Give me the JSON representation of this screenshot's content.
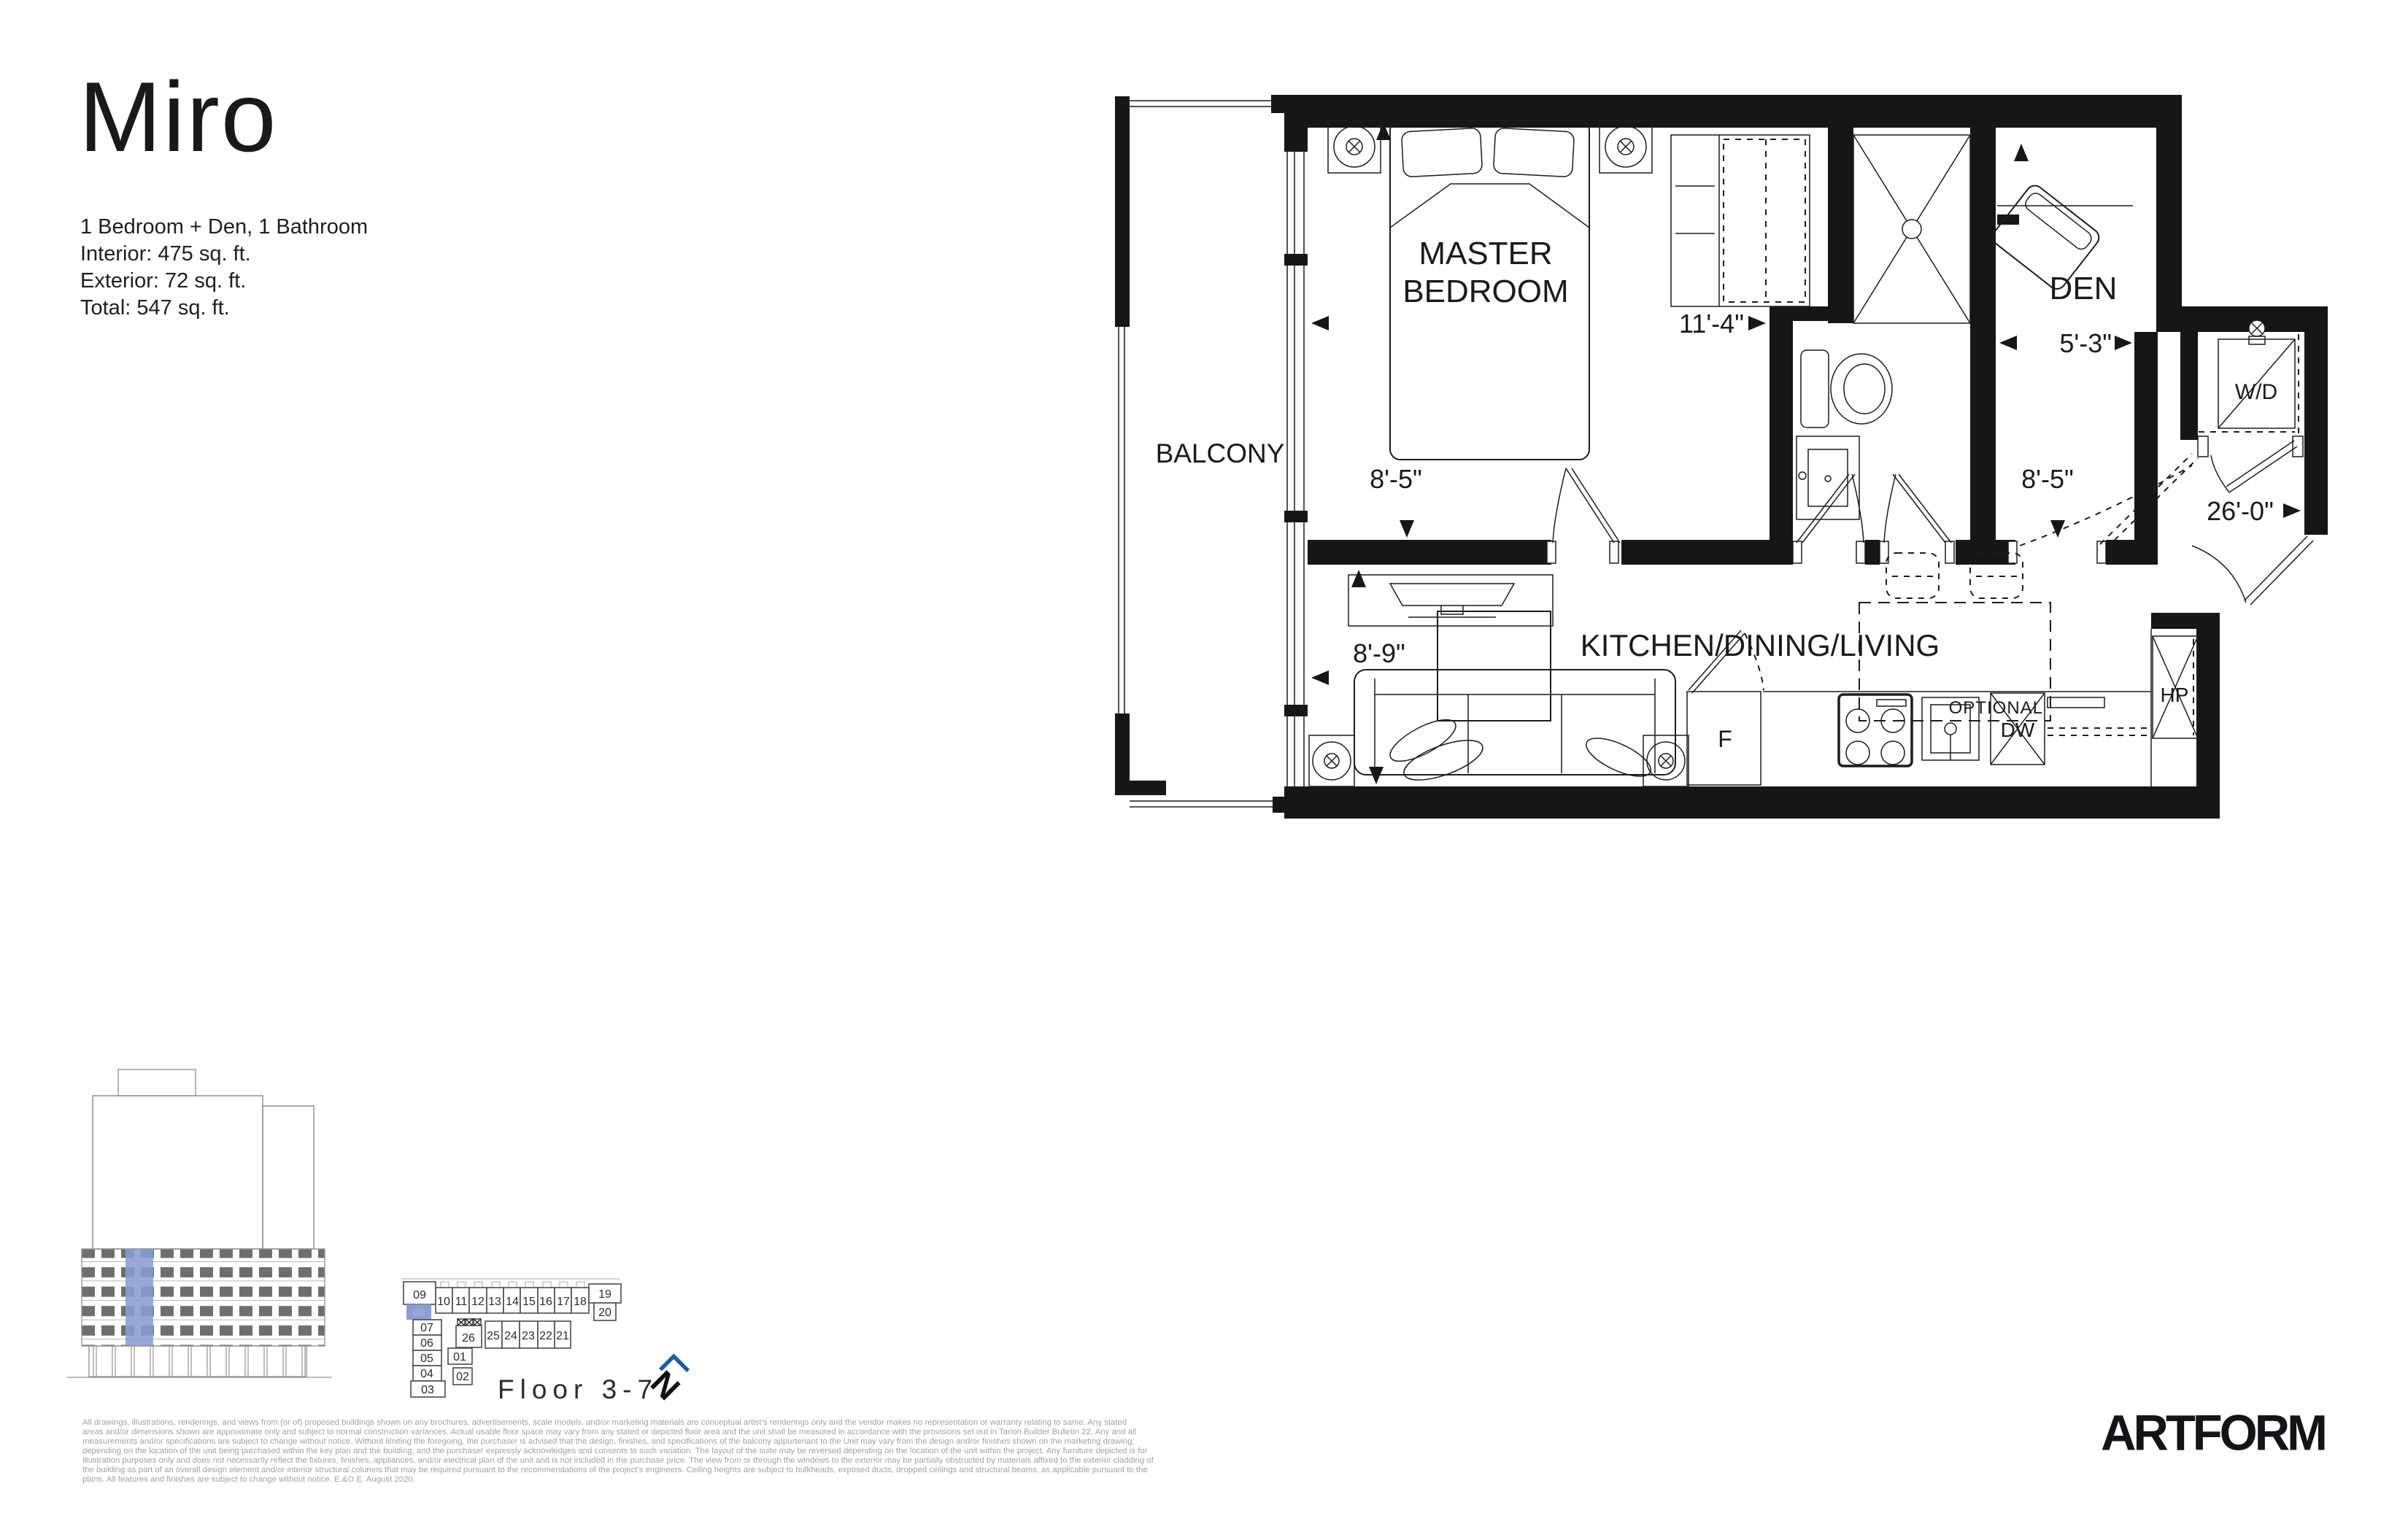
{
  "unit": {
    "name": "Miro",
    "type_line": "1 Bedroom + Den, 1 Bathroom",
    "interior_line": "Interior: 475 sq. ft.",
    "exterior_line": "Exterior: 72 sq. ft.",
    "total_line": "Total: 547 sq. ft."
  },
  "plan": {
    "labels": {
      "balcony": "BALCONY",
      "master_line1": "MASTER",
      "master_line2": "BEDROOM",
      "den": "DEN",
      "kitchen": "KITCHEN/DINING/LIVING",
      "optional": "OPTIONAL",
      "washer_dryer": "W/D",
      "heat_pump": "HP",
      "dishwasher": "DW",
      "fridge": "F"
    },
    "dimensions": {
      "master_width": "11'-4\"",
      "master_depth": "8'-5\"",
      "den_width": "5'-3\"",
      "den_depth": "8'-5\"",
      "living_width": "8'-9\"",
      "overall_depth": "26'-0\""
    }
  },
  "keyplan": {
    "floor_label": "Floor 3-7",
    "highlighted_unit": "08",
    "north_label": "N",
    "units": [
      "09",
      "10",
      "11",
      "12",
      "13",
      "14",
      "15",
      "16",
      "17",
      "18",
      "19",
      "20",
      "08",
      "07",
      "06",
      "05",
      "04",
      "03",
      "01",
      "02",
      "26",
      "25",
      "24",
      "23",
      "22",
      "21"
    ]
  },
  "footer": {
    "logo_text": "ARTFORM",
    "disclaimer_lines": [
      "All drawings, illustrations, renderings, and views from (or of) proposed buildings shown on any brochures, advertisements, scale models, and/or marketing materials are conceptual artist's renderings only and the vendor makes no representation or warranty relating to same. Any stated",
      "areas and/or dimensions shown are approximate only and subject to normal construction variances. Actual usable floor space may vary from any stated or depicted floor area and the unit shall be measured in accordance with the provisions set out in Tarion Builder Bulletin 22. Any and all",
      "measurements and/or specifications are subject to change without notice. Without limiting the foregoing, the purchaser is advised that the design, finishes, and specifications of the balcony appurtenant to the Unit may vary from the design and/or finishes shown on the marketing drawing,",
      "depending on the location of the unit being purchased within the key plan and the building, and the purchaser expressly acknowledges and consents to such variation. The layout of the suite may be reversed depending on the location of the unit within the project. Any furniture depicted is for",
      "illustration purposes only and does not necessarily reflect the fixtures, finishes, appliances, and/or electrical plan of the unit and is not included in the purchase price. The view from or through the windows to the exterior may be partially obstructed by materials affixed to the exterior cladding of",
      "the building as part of an overall design element and/or interior structural columns that may be required pursuant to the recommendations of the project's engineers. Ceiling heights are subject to bulkheads, exposed ducts, dropped ceilings and structural beams, as applicable pursuant to the",
      "plans. All features and finishes are subject to change without notice. E.&O.E. August 2020."
    ]
  },
  "colors": {
    "highlight_blue": "#8b9dd1",
    "north_blue": "#1f5c99"
  }
}
